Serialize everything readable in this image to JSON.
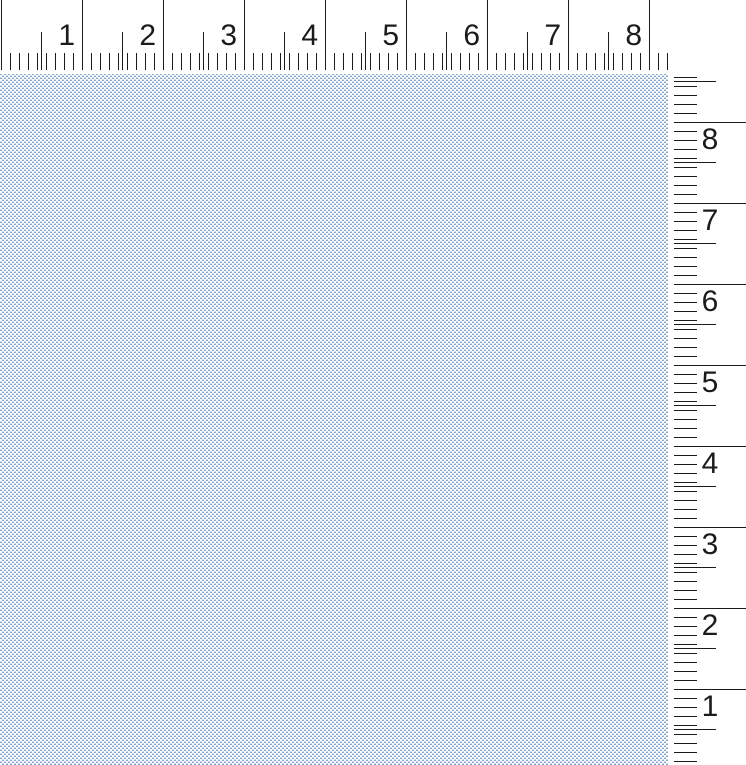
{
  "rulers": {
    "horizontal": {
      "labels": [
        "1",
        "2",
        "3",
        "4",
        "5",
        "6",
        "7",
        "8"
      ],
      "unit_px": 81,
      "fine_tick_px": 9
    },
    "vertical": {
      "labels": [
        "8",
        "7",
        "6",
        "5",
        "4",
        "3",
        "2",
        "1"
      ],
      "unit_px": 81,
      "fine_tick_px": 9
    }
  },
  "colors": {
    "tick": "#1b1b1b",
    "background": "#ffffff",
    "canvas_dash_strong": "#84a7c9",
    "canvas_dash_faint": "#c9d8ea"
  }
}
